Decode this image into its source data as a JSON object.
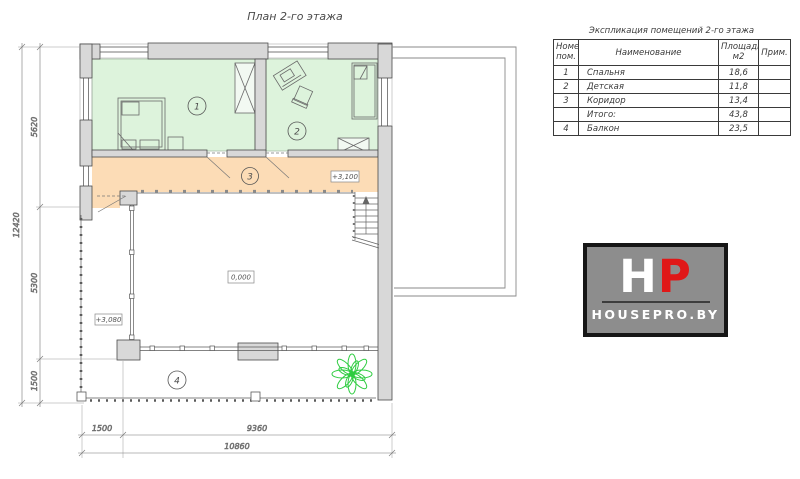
{
  "page": {
    "title": "План 2-го этажа"
  },
  "plan": {
    "rooms": [
      {
        "number": "1"
      },
      {
        "number": "2"
      },
      {
        "number": "3"
      },
      {
        "number": "4"
      }
    ],
    "levels": {
      "corridor": "+3,100",
      "first_floor": "0,000",
      "balcony": "+3,080"
    },
    "dimensions": {
      "left_outer": "12420",
      "left_inner": [
        "5620",
        "5300",
        "1500"
      ],
      "bottom_inner": [
        "1500",
        "9360"
      ],
      "bottom_outer": "10860"
    }
  },
  "table": {
    "title": "Экспликация помещений 2-го этажа",
    "headers": {
      "num_line1": "Номер",
      "num_line2": "пом.",
      "name": "Наименование",
      "area_line1": "Площадь,",
      "area_line2": "м2",
      "note": "Прим."
    },
    "rows": [
      {
        "num": "1",
        "name": "Спальня",
        "area": "18,6",
        "note": ""
      },
      {
        "num": "2",
        "name": "Детская",
        "area": "11,8",
        "note": ""
      },
      {
        "num": "3",
        "name": "Коридор",
        "area": "13,4",
        "note": ""
      },
      {
        "num": "",
        "name": "Итого:",
        "area": "43,8",
        "note": ""
      },
      {
        "num": "4",
        "name": "Балкон",
        "area": "23,5",
        "note": ""
      }
    ]
  },
  "logo": {
    "letter_h": "H",
    "letter_p": "P",
    "site": "HOUSEPRO.BY",
    "p_color": "#e01818",
    "bg_color": "#8d8d8d"
  },
  "colors": {
    "room_fill": "#ddf3dc",
    "corridor_fill": "#fcdcb6",
    "wall_fill": "#d8d8d8",
    "plant_green": "#2ecc40"
  }
}
